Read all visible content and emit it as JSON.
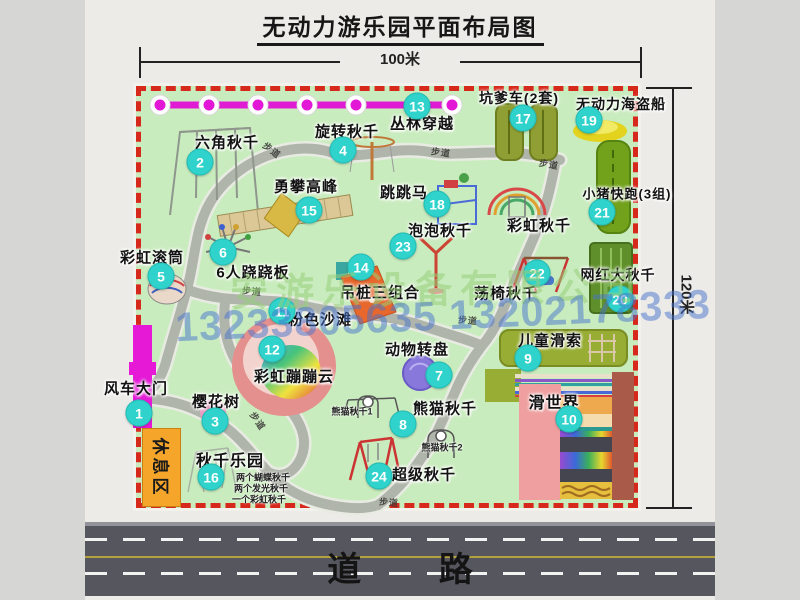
{
  "title": "无动力游乐园平面布局图",
  "dimensions": {
    "width_label": "100米",
    "height_label": "120米"
  },
  "road": {
    "label": "道  路"
  },
  "rest_area_label": "休息区",
  "watermarks": {
    "company": "安游乐设备有限公司",
    "phone": "13233805635 13202178333"
  },
  "colors": {
    "map_green": "#c9ecbe",
    "border_red": "#d7281c",
    "badge_cyan": "#2fd3cb",
    "chain_magenta": "#e01ad2",
    "gate_magenta": "#e519d6",
    "rest_orange": "#f5a62a",
    "road_gray": "#56565e",
    "path_gray": "#b0b5ab"
  },
  "path_label_text": "步道",
  "path_labels": [
    {
      "x": 272,
      "y": 150,
      "rot": 38
    },
    {
      "x": 441,
      "y": 152,
      "rot": 8
    },
    {
      "x": 549,
      "y": 164,
      "rot": 10
    },
    {
      "x": 252,
      "y": 291,
      "rot": 5
    },
    {
      "x": 468,
      "y": 320,
      "rot": 5
    },
    {
      "x": 258,
      "y": 421,
      "rot": 55
    },
    {
      "x": 389,
      "y": 502,
      "rot": 5
    }
  ],
  "items": [
    {
      "n": "1",
      "label": "风车大门",
      "lx": 136,
      "ly": 388,
      "cx": 139,
      "cy": 413,
      "size": 15
    },
    {
      "n": "2",
      "label": "六角秋千",
      "lx": 227,
      "ly": 142,
      "cx": 200,
      "cy": 162,
      "size": 15
    },
    {
      "n": "3",
      "label": "樱花树",
      "lx": 216,
      "ly": 401,
      "cx": 215,
      "cy": 421,
      "size": 15
    },
    {
      "n": "4",
      "label": "旋转秋千",
      "lx": 347,
      "ly": 131,
      "cx": 343,
      "cy": 150,
      "size": 15
    },
    {
      "n": "5",
      "label": "彩虹滚筒",
      "lx": 152,
      "ly": 257,
      "cx": 161,
      "cy": 276,
      "size": 15
    },
    {
      "n": "6",
      "label": "6人跷跷板",
      "lx": 253,
      "ly": 272,
      "cx": 223,
      "cy": 252,
      "size": 15
    },
    {
      "n": "7",
      "label": "动物转盘",
      "lx": 417,
      "ly": 349,
      "cx": 439,
      "cy": 375,
      "size": 15
    },
    {
      "n": "8",
      "label": "熊猫秋千",
      "lx": 445,
      "ly": 408,
      "cx": 403,
      "cy": 424,
      "size": 15
    },
    {
      "n": "9",
      "label": "儿童滑索",
      "lx": 550,
      "ly": 340,
      "cx": 528,
      "cy": 358,
      "size": 15
    },
    {
      "n": "10",
      "label": "滑世界",
      "lx": 554,
      "ly": 401,
      "cx": 569,
      "cy": 419,
      "size": 16
    },
    {
      "n": "11",
      "label": "粉色沙滩",
      "lx": 320,
      "ly": 319,
      "cx": 282,
      "cy": 311,
      "size": 15
    },
    {
      "n": "12",
      "label": "彩虹蹦蹦云",
      "lx": 294,
      "ly": 376,
      "cx": 272,
      "cy": 349,
      "size": 15
    },
    {
      "n": "13",
      "label": "丛林穿越",
      "lx": 422,
      "ly": 123,
      "cx": 417,
      "cy": 106,
      "size": 15
    },
    {
      "n": "14",
      "label": "吊桩三组合",
      "lx": 380,
      "ly": 292,
      "cx": 361,
      "cy": 267,
      "size": 15
    },
    {
      "n": "15",
      "label": "勇攀高峰",
      "lx": 306,
      "ly": 186,
      "cx": 309,
      "cy": 210,
      "size": 15
    },
    {
      "n": "16",
      "label": "秋千乐园",
      "lx": 230,
      "ly": 459,
      "cx": 211,
      "cy": 477,
      "size": 16
    },
    {
      "n": "17",
      "label": "坑爹车(2套)",
      "lx": 519,
      "ly": 98,
      "cx": 523,
      "cy": 118,
      "size": 14
    },
    {
      "n": "18",
      "label": "跳跳马",
      "lx": 404,
      "ly": 192,
      "cx": 437,
      "cy": 204,
      "size": 15
    },
    {
      "n": "19",
      "label": "无动力海盗船",
      "lx": 621,
      "ly": 104,
      "cx": 589,
      "cy": 120,
      "size": 14
    },
    {
      "n": "20",
      "label": "网红大秋千",
      "lx": 618,
      "ly": 275,
      "cx": 620,
      "cy": 299,
      "size": 14
    },
    {
      "n": "21",
      "label": "小猪快跑(3组)",
      "lx": 627,
      "ly": 193,
      "cx": 602,
      "cy": 212,
      "size": 13
    },
    {
      "n": "22",
      "label": "荡椅秋千",
      "lx": 506,
      "ly": 293,
      "cx": 537,
      "cy": 273,
      "size": 15
    },
    {
      "n": "23",
      "label": "泡泡秋千",
      "lx": 440,
      "ly": 230,
      "cx": 403,
      "cy": 246,
      "size": 15
    },
    {
      "n": "24",
      "label": "超级秋千",
      "lx": 424,
      "ly": 474,
      "cx": 379,
      "cy": 476,
      "size": 15
    },
    {
      "n": null,
      "label": "彩虹秋千",
      "lx": 539,
      "ly": 225,
      "cx": null,
      "cy": null,
      "size": 15
    }
  ],
  "sub_labels": [
    {
      "text": "熊猫秋千1",
      "x": 352,
      "y": 411,
      "size": 9
    },
    {
      "text": "熊猫秋千2",
      "x": 442,
      "y": 447,
      "size": 9
    },
    {
      "text": "两个蝴蝶秋千",
      "x": 263,
      "y": 477,
      "size": 9
    },
    {
      "text": "两个发光秋千",
      "x": 261,
      "y": 488,
      "size": 9
    },
    {
      "text": "一个彩虹秋千",
      "x": 259,
      "y": 499,
      "size": 9
    }
  ]
}
